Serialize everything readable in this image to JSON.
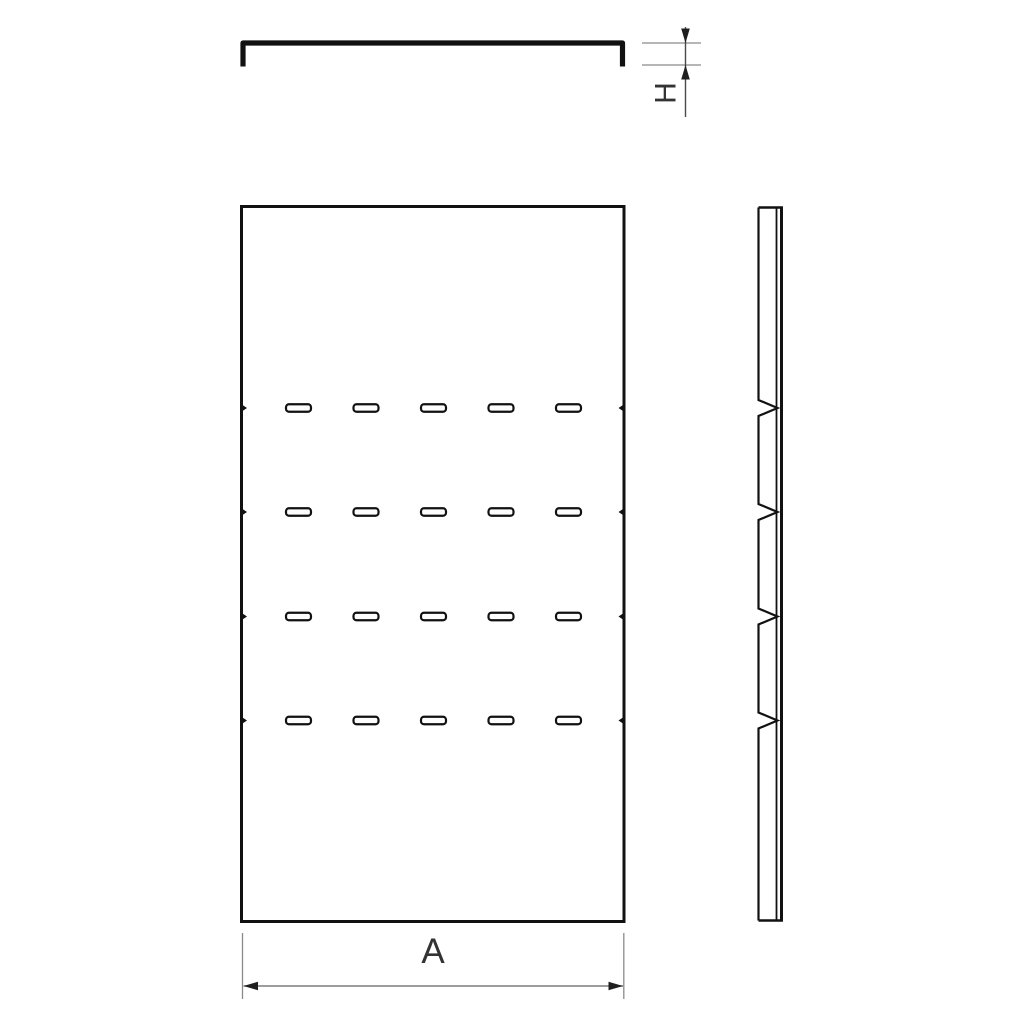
{
  "colors": {
    "background": "#ffffff",
    "line": "#111111",
    "dimension_line": "#8a8a8a",
    "dimension_text": "#333333"
  },
  "dimension_labels": {
    "height": "H",
    "width": "A"
  },
  "plan_view": {
    "slot_rows": 4,
    "slot_columns": 5,
    "slots_total": 20,
    "edge_notch_pairs": 4
  },
  "side_view": {
    "notches": 4
  }
}
